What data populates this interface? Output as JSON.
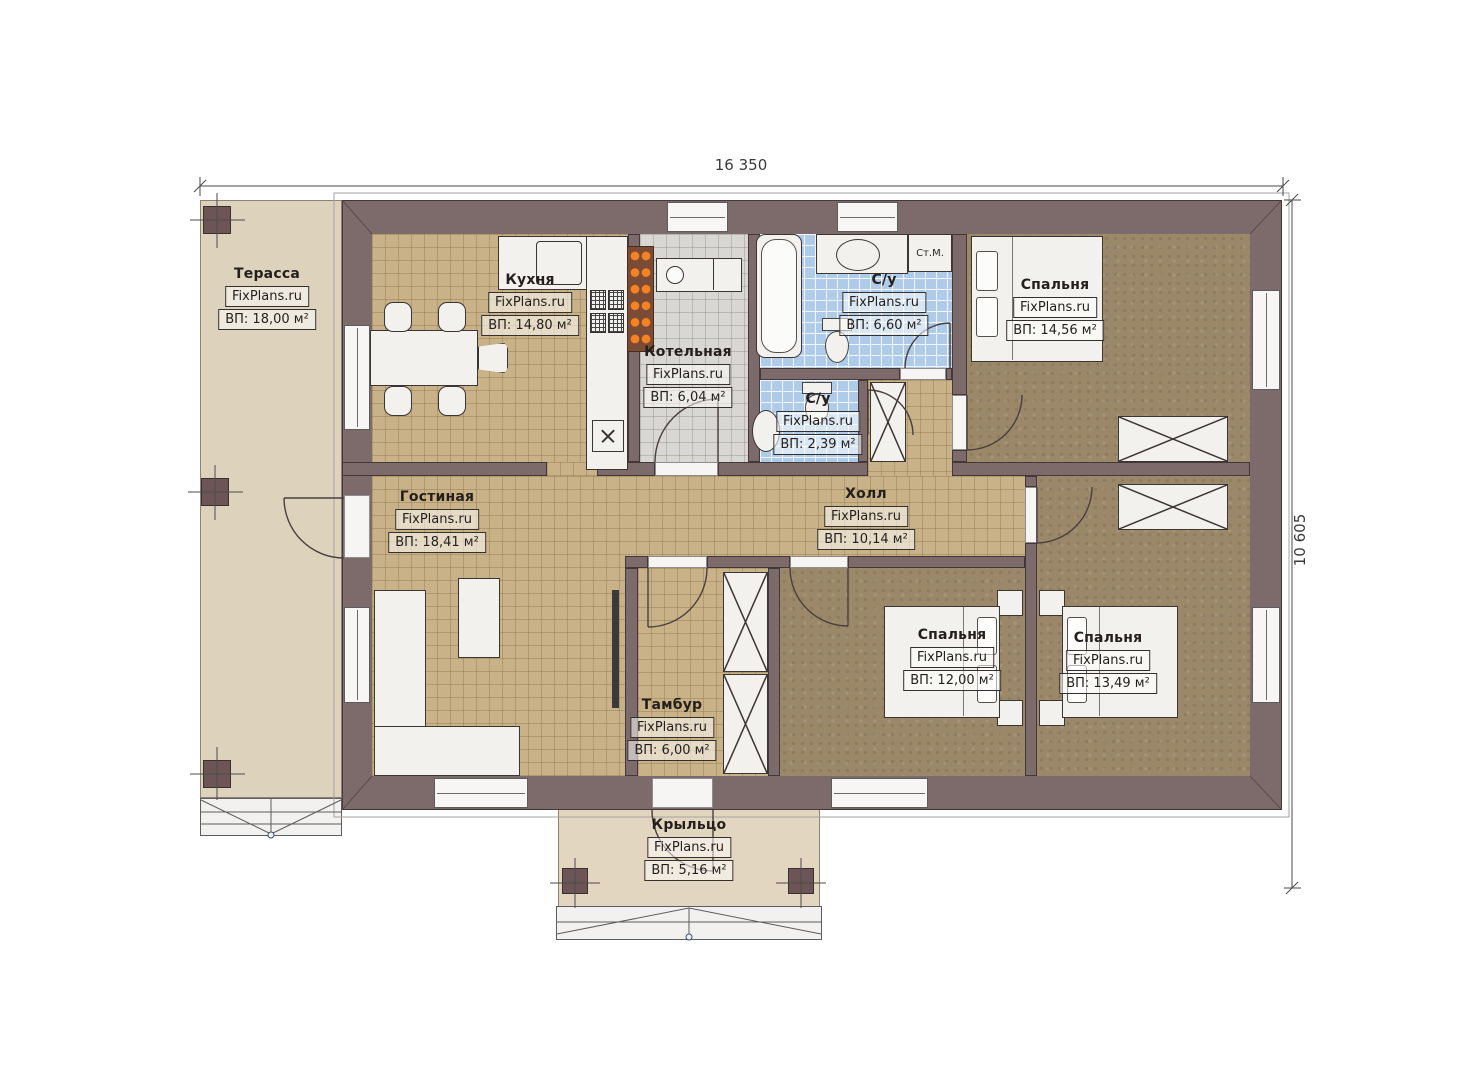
{
  "watermark": "FixPlans.ru",
  "dimensions": {
    "top": "16 350",
    "right": "10 605"
  },
  "rooms": {
    "terrace": {
      "name": "Терасса",
      "area": "ВП: 18,00 м²"
    },
    "kitchen": {
      "name": "Кухня",
      "area": "ВП: 14,80 м²"
    },
    "boiler": {
      "name": "Котельная",
      "area": "ВП: 6,04 м²"
    },
    "bathroom_main": {
      "name": "С/у",
      "area": "ВП: 6,60 м²"
    },
    "bathroom_small": {
      "name": "С/у",
      "area": "ВП: 2,39 м²"
    },
    "bedroom_top": {
      "name": "Спальня",
      "area": "ВП: 14,56 м²"
    },
    "living": {
      "name": "Гостиная",
      "area": "ВП: 18,41 м²"
    },
    "hall": {
      "name": "Холл",
      "area": "ВП: 10,14 м²"
    },
    "vestibule": {
      "name": "Тамбур",
      "area": "ВП: 6,00 м²"
    },
    "bedroom_left": {
      "name": "Спальня",
      "area": "ВП: 12,00 м²"
    },
    "bedroom_right": {
      "name": "Спальня",
      "area": "ВП: 13,49 м²"
    },
    "porch": {
      "name": "Крыльцо",
      "area": "ВП: 5,16 м²"
    }
  },
  "appliances": {
    "washing_machine": "Ст.М."
  },
  "colors": {
    "wall": "#7d6a6b",
    "floor_tile_tan": "#c9b287",
    "floor_tile_blue": "#aecbe9",
    "floor_tile_gray": "#d9d7d3",
    "floor_bedroom": "#9b8869",
    "terrace": "#ddd2bc",
    "porch": "#e3d6c0",
    "flame_accent": "#f68222"
  }
}
